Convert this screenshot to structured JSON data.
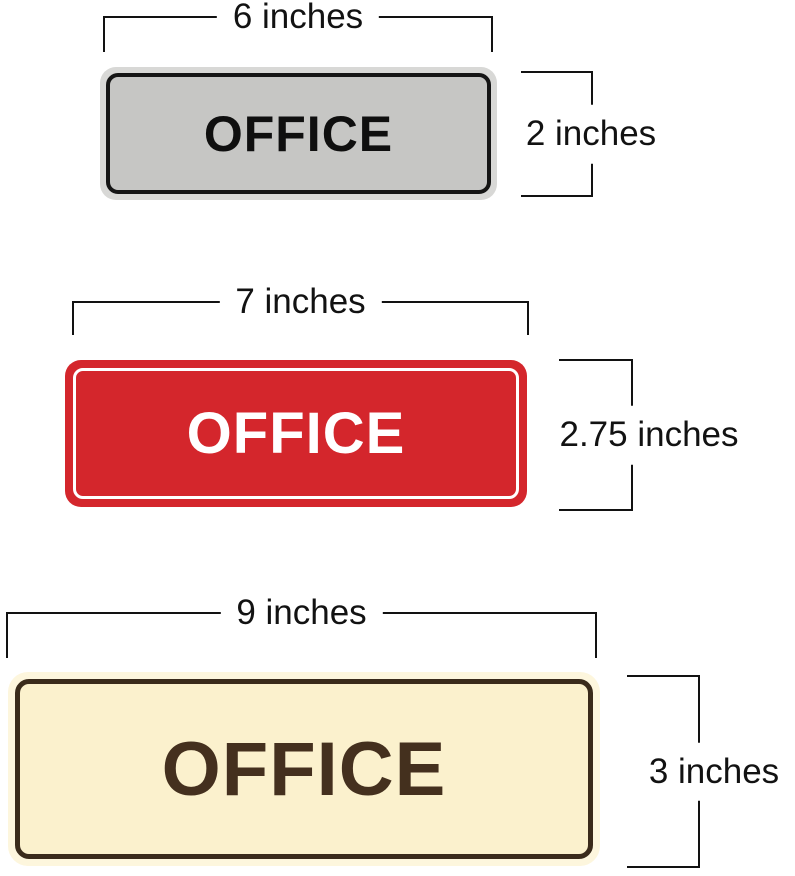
{
  "diagram": {
    "background_color": "#ffffff",
    "dimension_line_color": "#121212",
    "signs": [
      {
        "name": "gray-office-sign",
        "text": "OFFICE",
        "width_label": "6 inches",
        "height_label": "2 inches",
        "face_color": "#c6c6c4",
        "frame_color": "#d8d8d6",
        "border_color": "#151515",
        "text_color": "#0f0f0f"
      },
      {
        "name": "red-office-sign",
        "text": "OFFICE",
        "width_label": "7 inches",
        "height_label": "2.75 inches",
        "face_color": "#d4262c",
        "border_color": "#ffffff",
        "text_color": "#ffffff"
      },
      {
        "name": "cream-office-sign",
        "text": "OFFICE",
        "width_label": "9 inches",
        "height_label": "3 inches",
        "face_color": "#fbf1cd",
        "frame_color": "#fdf6dd",
        "border_color": "#3a2b1b",
        "text_color": "#44301e"
      }
    ]
  }
}
